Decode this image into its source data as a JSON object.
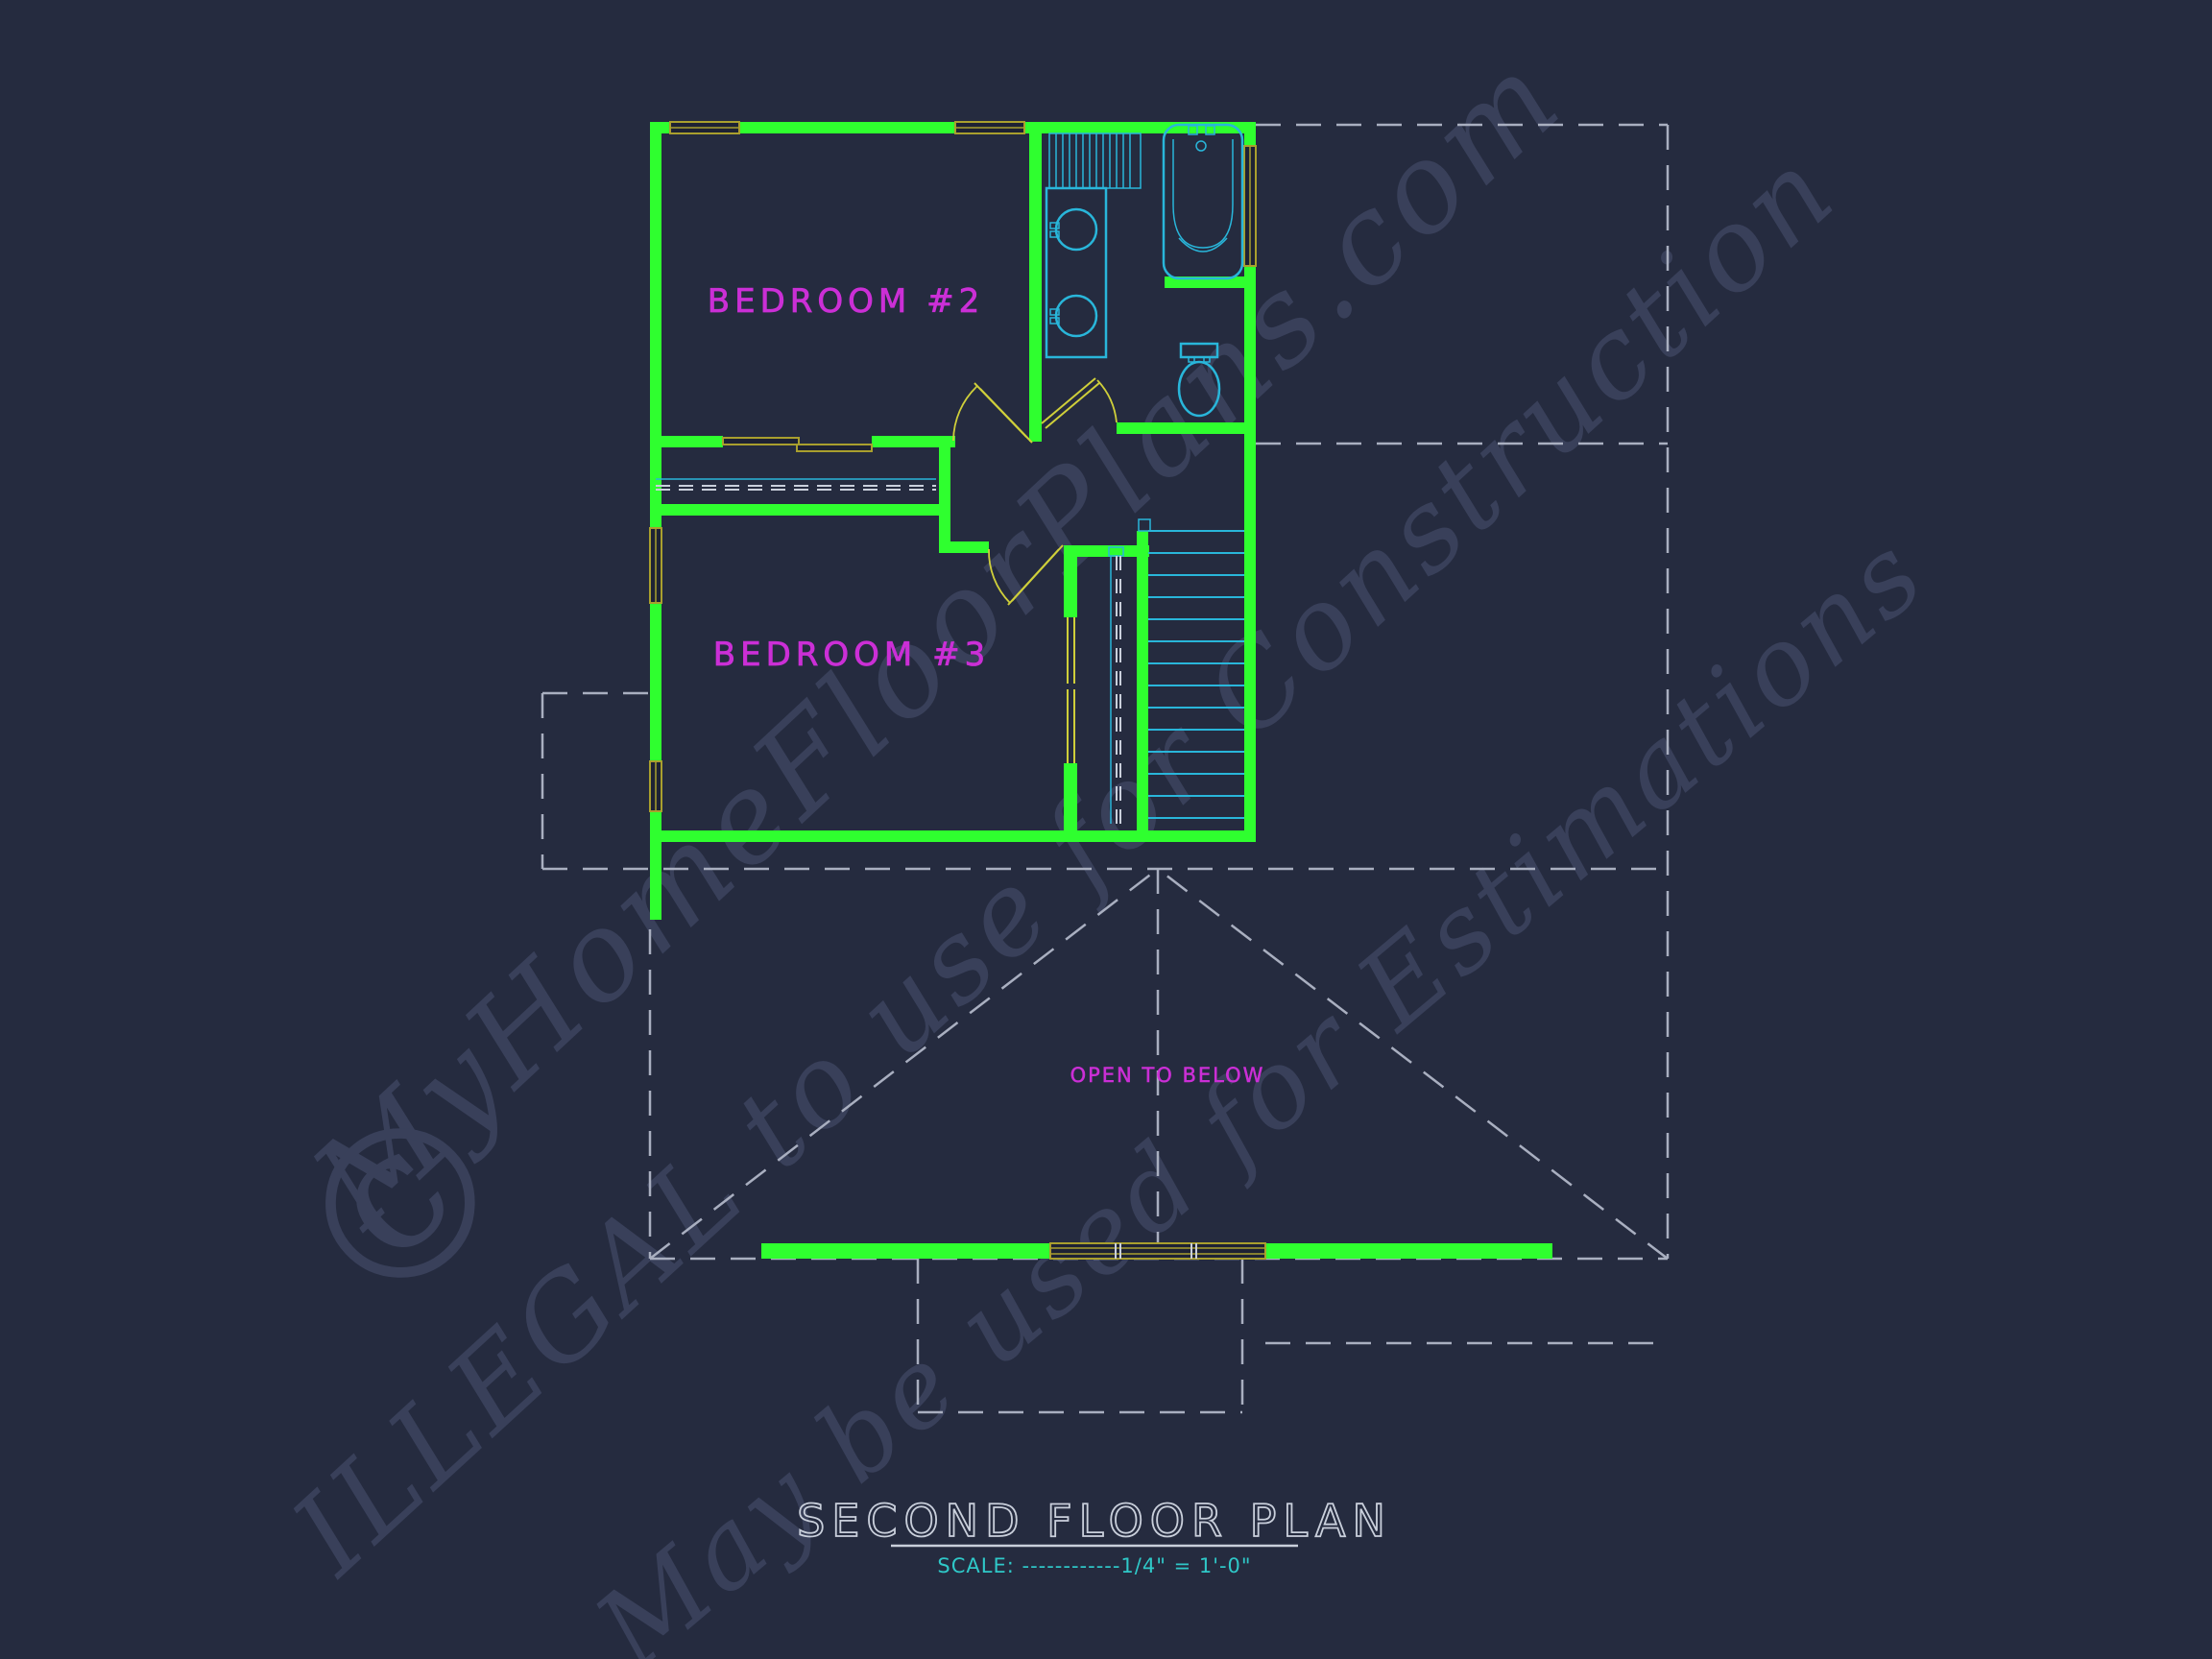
{
  "title_block": {
    "title": "SECOND FLOOR PLAN",
    "scale": "SCALE: ------------1/4\" = 1'-0\""
  },
  "rooms": {
    "bedroom2": "BEDROOM #2",
    "bedroom3": "BEDROOM #3",
    "open_below": "OPEN TO BELOW"
  },
  "watermark": {
    "line1": "MyHomeFloorPlans.com",
    "line2": "ILLEGAL to use for Construction",
    "line3": "May be used for Estimations",
    "copyright": "©"
  },
  "colors": {
    "background": "#252B3F",
    "wall": "#2FFF2F",
    "window": "#A99F2E",
    "door": "#CFCF3A",
    "fixture": "#29B6DA",
    "label": "#CB2FD6",
    "dashed": "#A9AFC0",
    "title": "#C9CFDB",
    "scale_text": "#2FC8C8",
    "watermark": "#39405A"
  }
}
